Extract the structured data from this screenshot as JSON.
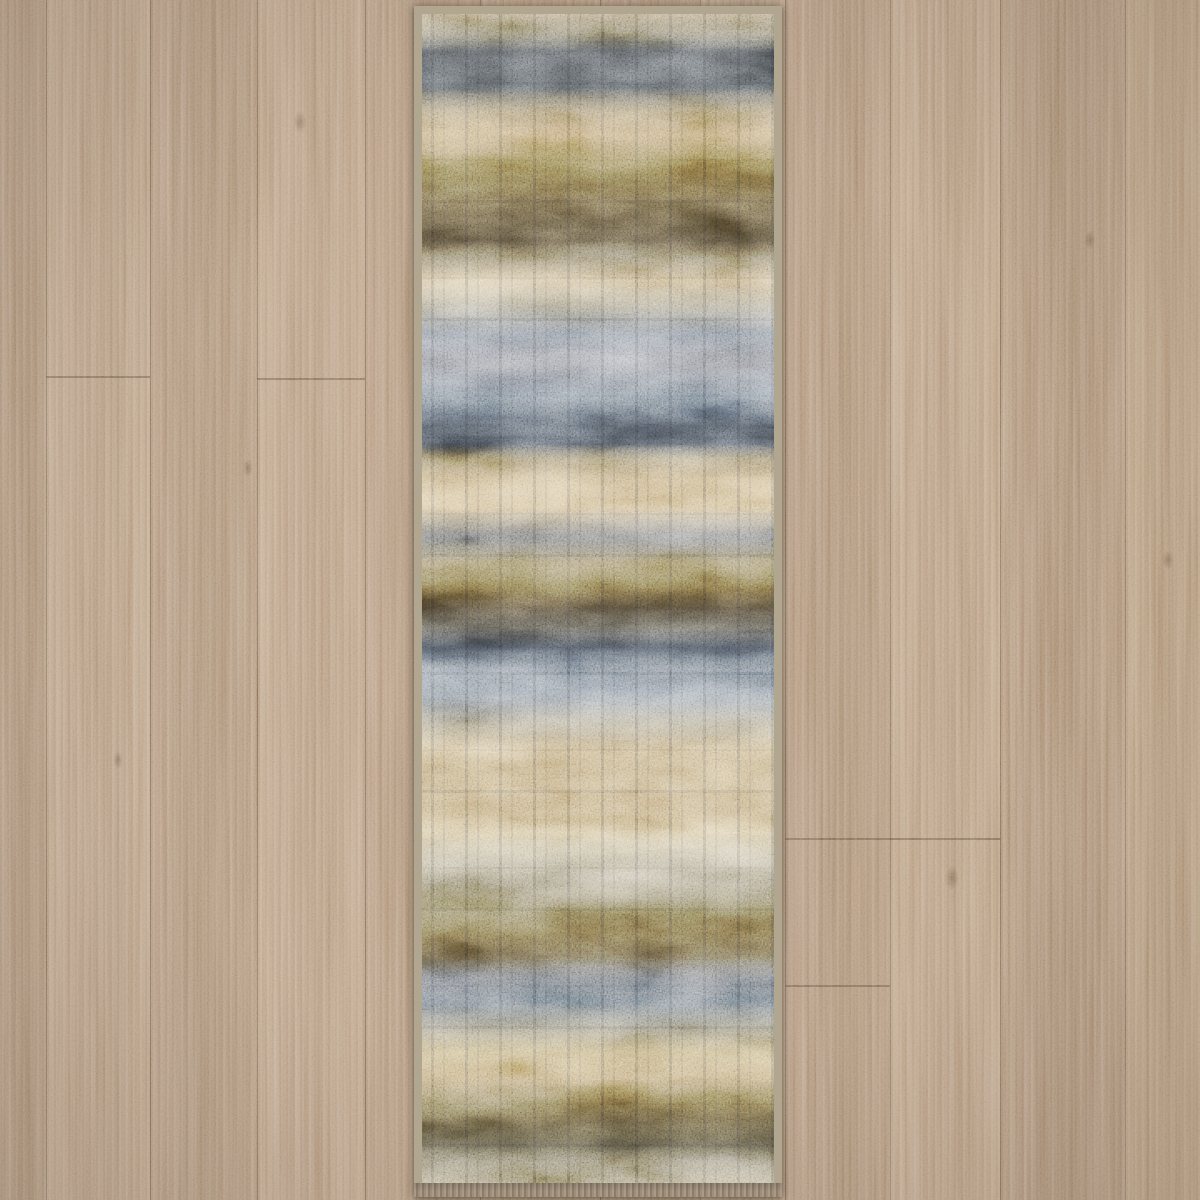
{
  "image": {
    "width": 1200,
    "height": 1200,
    "description": "Overhead product photo of an abstract distressed runner rug in beige, bronze-olive, charcoal-navy and slate blue-gray, lying vertically centered on light brown oak laminate plank flooring with vertical planks."
  },
  "floor": {
    "base_color": "#b09478",
    "grain_color": "#8a6f57",
    "seam_color": "#5c4938",
    "planks": [
      {
        "x": 0,
        "w": 46,
        "tone": "#ac9074"
      },
      {
        "x": 46,
        "w": 104,
        "tone": "#b79c80"
      },
      {
        "x": 150,
        "w": 107,
        "tone": "#ae9276"
      },
      {
        "x": 257,
        "w": 108,
        "tone": "#b99d81"
      },
      {
        "x": 365,
        "w": 115,
        "tone": "#b19478"
      },
      {
        "x": 480,
        "w": 120,
        "tone": "#b39679"
      },
      {
        "x": 600,
        "w": 100,
        "tone": "#af9276"
      },
      {
        "x": 700,
        "w": 85,
        "tone": "#b59a7d"
      },
      {
        "x": 785,
        "w": 105,
        "tone": "#ae9175"
      },
      {
        "x": 890,
        "w": 110,
        "tone": "#b89c7f"
      },
      {
        "x": 1000,
        "w": 125,
        "tone": "#ab8e72"
      },
      {
        "x": 1125,
        "w": 75,
        "tone": "#b49878"
      }
    ],
    "plank_end_seams": [
      {
        "x": 46,
        "w": 104,
        "y": 376
      },
      {
        "x": 257,
        "w": 108,
        "y": 378
      },
      {
        "x": 785,
        "w": 215,
        "y": 838
      },
      {
        "x": 785,
        "w": 105,
        "y": 985
      }
    ],
    "knots": [
      {
        "x": 300,
        "y": 122,
        "r": 9
      },
      {
        "x": 248,
        "y": 468,
        "r": 7
      },
      {
        "x": 1090,
        "y": 240,
        "r": 8
      },
      {
        "x": 952,
        "y": 878,
        "r": 10
      },
      {
        "x": 118,
        "y": 760,
        "r": 7
      },
      {
        "x": 1168,
        "y": 560,
        "r": 8
      }
    ]
  },
  "rug": {
    "left": 414,
    "top": 6,
    "width": 368,
    "height": 1191,
    "binding_color": "#b1a791",
    "binding_top": 8,
    "binding_side": 8,
    "binding_bottom": 14,
    "endcap_color": "#9e8e7a",
    "palette": {
      "cream": "#e3d2a9",
      "beige": "#d3bd92",
      "tan_gold": "#c5a76f",
      "olive_bronze": "#6f5a2f",
      "dark_brown": "#3a3122",
      "charcoal_navy": "#353c46",
      "slate": "#6e7b88",
      "slate_light": "#8a949e"
    },
    "bands": [
      {
        "p": 0,
        "c": "#a89674"
      },
      {
        "p": 1.6,
        "c": "#8f876e"
      },
      {
        "p": 3.2,
        "c": "#3f4347"
      },
      {
        "p": 6.3,
        "c": "#454a4e"
      },
      {
        "p": 8.3,
        "c": "#9d8a64"
      },
      {
        "p": 10.3,
        "c": "#b89c6c"
      },
      {
        "p": 12.5,
        "c": "#8c7848"
      },
      {
        "p": 14.4,
        "c": "#6c5c36"
      },
      {
        "p": 16.8,
        "c": "#554930"
      },
      {
        "p": 19.4,
        "c": "#403726"
      },
      {
        "p": 21.1,
        "c": "#8d7f5f"
      },
      {
        "p": 22.8,
        "c": "#c6b189"
      },
      {
        "p": 24.8,
        "c": "#a8a089"
      },
      {
        "p": 27.4,
        "c": "#7e8793"
      },
      {
        "p": 29.9,
        "c": "#8e9097"
      },
      {
        "p": 32.8,
        "c": "#6f7c8a"
      },
      {
        "p": 35.2,
        "c": "#3a414a"
      },
      {
        "p": 36.8,
        "c": "#3d444d"
      },
      {
        "p": 38.1,
        "c": "#9a8a66"
      },
      {
        "p": 39.8,
        "c": "#c0a87b"
      },
      {
        "p": 42.2,
        "c": "#cbb58b"
      },
      {
        "p": 44.8,
        "c": "#787a7c"
      },
      {
        "p": 47.0,
        "c": "#8c7b51"
      },
      {
        "p": 49.1,
        "c": "#6d5c34"
      },
      {
        "p": 50.8,
        "c": "#3a3122"
      },
      {
        "p": 52.5,
        "c": "#504d45"
      },
      {
        "p": 54.2,
        "c": "#353c46"
      },
      {
        "p": 56.1,
        "c": "#77828e"
      },
      {
        "p": 58.4,
        "c": "#8a949e"
      },
      {
        "p": 60.7,
        "c": "#a9a18b"
      },
      {
        "p": 62.9,
        "c": "#c3ad83"
      },
      {
        "p": 64.9,
        "c": "#b39a6b"
      },
      {
        "p": 67.5,
        "c": "#b9a072"
      },
      {
        "p": 70.0,
        "c": "#ccba92"
      },
      {
        "p": 72.3,
        "c": "#b4ab91"
      },
      {
        "p": 74.3,
        "c": "#a29980"
      },
      {
        "p": 76.4,
        "c": "#80744f"
      },
      {
        "p": 78.6,
        "c": "#6c5c37"
      },
      {
        "p": 80.6,
        "c": "#5b5037"
      },
      {
        "p": 82.5,
        "c": "#6a6f76"
      },
      {
        "p": 84.6,
        "c": "#6d7883"
      },
      {
        "p": 86.6,
        "c": "#8e8975"
      },
      {
        "p": 88.8,
        "c": "#bba775"
      },
      {
        "p": 91.0,
        "c": "#b89f6f"
      },
      {
        "p": 93.1,
        "c": "#796941"
      },
      {
        "p": 94.8,
        "c": "#4e442b"
      },
      {
        "p": 96.8,
        "c": "#3e3929"
      },
      {
        "p": 98.2,
        "c": "#898067"
      },
      {
        "p": 100,
        "c": "#a69c7f"
      }
    ]
  }
}
